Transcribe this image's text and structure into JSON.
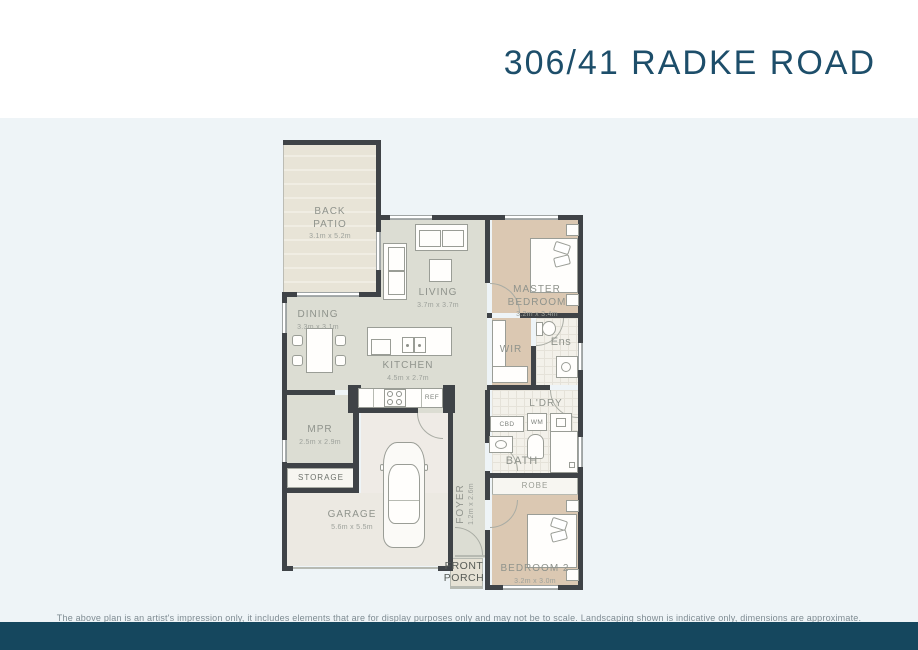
{
  "header": {
    "title": "306/41 RADKE ROAD"
  },
  "rooms": {
    "back_patio": {
      "name": "BACK PATIO",
      "dims": "3.1m x 5.2m"
    },
    "living": {
      "name": "LIVING",
      "dims": "3.7m x 3.7m"
    },
    "master_bedroom": {
      "name": "MASTER BEDROOM",
      "dims": "3.2m x 3.4m"
    },
    "dining": {
      "name": "DINING",
      "dims": "3.3m x 3.1m"
    },
    "kitchen": {
      "name": "KITCHEN",
      "dims": "4.5m x 2.7m"
    },
    "wir": {
      "name": "WIR"
    },
    "ens": {
      "name": "Ens"
    },
    "ldry": {
      "name": "L'DRY"
    },
    "bath": {
      "name": "BATH"
    },
    "mpr": {
      "name": "MPR",
      "dims": "2.5m x 2.9m"
    },
    "storage": {
      "name": "STORAGE"
    },
    "garage": {
      "name": "GARAGE",
      "dims": "5.6m x 5.5m"
    },
    "foyer": {
      "name": "FOYER",
      "dims": "1.2m x 2.6m"
    },
    "robe": {
      "name": "ROBE"
    },
    "bedroom2": {
      "name": "BEDROOM 2",
      "dims": "3.2m x 3.0m"
    },
    "front_porch": {
      "name": "FRONT PORCH"
    }
  },
  "fixtures": {
    "ref": "REF",
    "cbd": "CBD",
    "wm": "WM"
  },
  "disclaimer": "The above plan is an artist's impression only, it includes elements that are for display purposes only and may not be to scale. Landscaping shown is indicative only, dimensions are approximate.",
  "colors": {
    "accent_navy": "#1d4e6a",
    "footer_bar": "#15475e",
    "wall": "#3f4347",
    "floor_sage": "#dcddd3",
    "floor_tan": "#dbc8b2",
    "plan_background": "#eef4f7"
  }
}
